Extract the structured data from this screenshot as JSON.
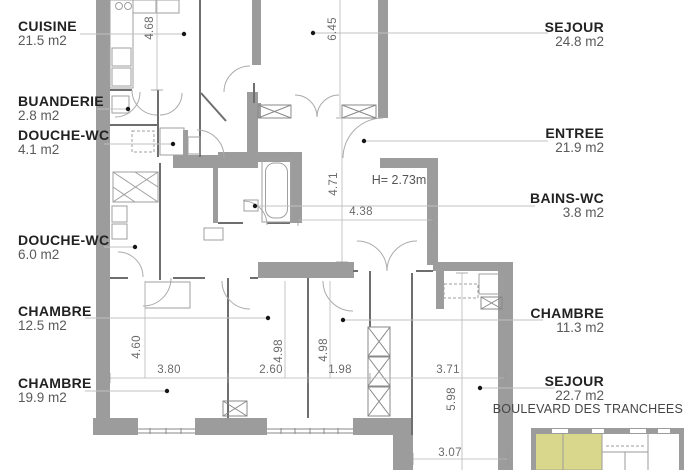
{
  "rooms": [
    {
      "name": "CUISINE",
      "area": "21.5 m2"
    },
    {
      "name": "BUANDERIE",
      "area": "2.8 m2"
    },
    {
      "name": "DOUCHE-WC",
      "area": "4.1 m2"
    },
    {
      "name": "DOUCHE-WC",
      "area": "6.0 m2"
    },
    {
      "name": "CHAMBRE",
      "area": "12.5 m2"
    },
    {
      "name": "CHAMBRE",
      "area": "19.9 m2"
    },
    {
      "name": "SEJOUR",
      "area": "24.8 m2"
    },
    {
      "name": "ENTREE",
      "area": "21.9 m2"
    },
    {
      "name": "BAINS-WC",
      "area": "3.8 m2"
    },
    {
      "name": "CHAMBRE",
      "area": "11.3 m2"
    },
    {
      "name": "SEJOUR",
      "area": "22.7 m2"
    }
  ],
  "dims": {
    "d468": "4.68",
    "d645": "6.45",
    "d471": "4.71",
    "d438": "4.38",
    "d460": "4.60",
    "d498a": "4.98",
    "d498b": "4.98",
    "d598": "5.98",
    "d380": "3.80",
    "d260": "2.60",
    "d198": "1.98",
    "d371": "3.71",
    "d307": "3.07",
    "height_note": "H= 2.73m"
  },
  "key_plan": {
    "street": "BOULEVARD DES TRANCHEES"
  },
  "colors": {
    "wall": "#9c9c9c",
    "highlight": "#d9d78b",
    "leader": "#c0c0c0",
    "dim_text": "#6b6b6b",
    "label_name": "#222222",
    "label_area": "#5a5a5a"
  }
}
